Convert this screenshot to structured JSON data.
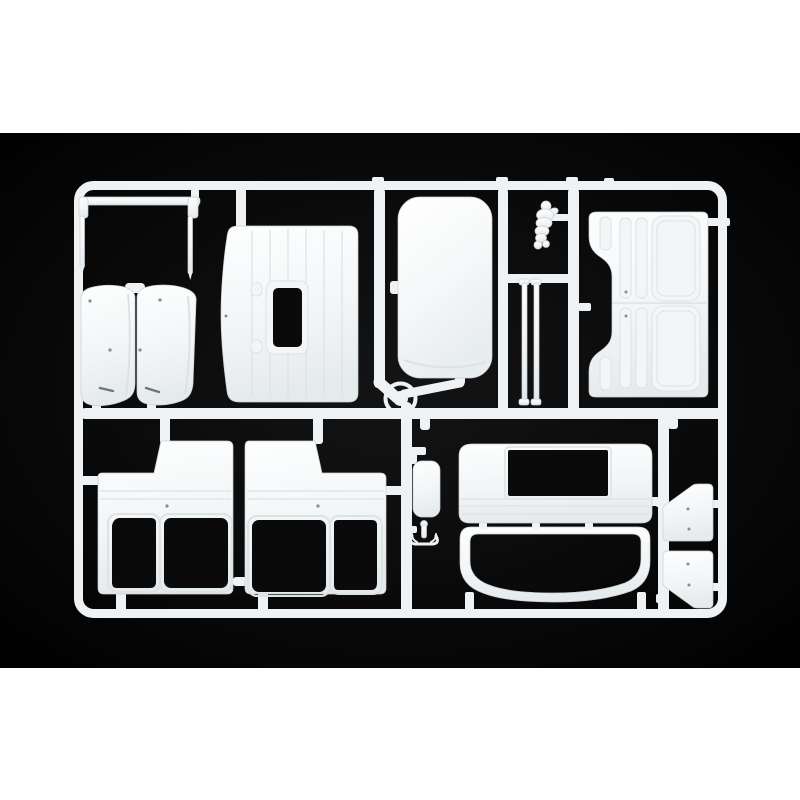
{
  "meta": {
    "subject": "injection-molded model kit sprue with white truck-cab body parts",
    "setting": "studio photo on black backdrop with white borders above and below"
  },
  "colors": {
    "page_bg": "#ffffff",
    "photo_bg": "#050505",
    "photo_bg_center": "#131313",
    "plastic": "#eff2f4",
    "plastic_edge": "#c9cfd4",
    "ridge": "#dde2e5",
    "hole": "#0a0a0a",
    "dot": "#878e92"
  },
  "parts": {
    "frame": "rectangular sprue runner frame",
    "mirror_bar": "thin mirror-arm bar with two hanging rods",
    "mudguard_pair": "two curved mudguard panels",
    "back_panel": "cab back panel with small window opening",
    "roof_panel": "smooth cab roof panel",
    "mascot_figurine": "small mascot figurine",
    "grab_rods": "two thin grab-rail rods",
    "door_panels": "two stacked door panels with recessed windows",
    "side_panel_left": "left cab side panel with two window openings",
    "side_panel_right": "right cab side panel with two window openings",
    "front_panel": "cab front panel with rectangular opening",
    "windshield_frame": "windshield surround frame",
    "deflector_pair": "two corner deflector panels",
    "hatch_cover": "small hatch cover",
    "hook_part": "small hook fitting",
    "sprue_hub": "central sprue gate hub"
  }
}
